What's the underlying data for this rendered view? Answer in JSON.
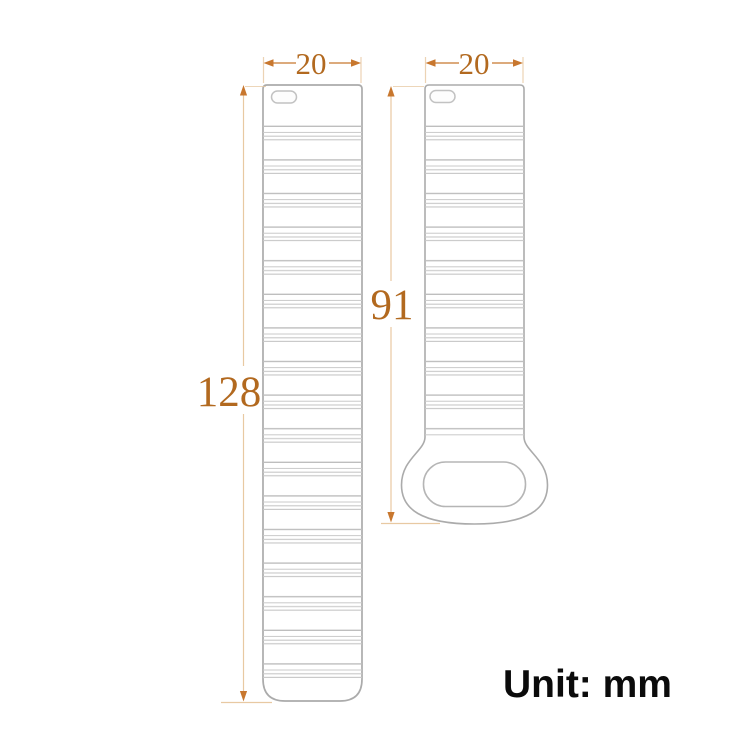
{
  "diagram": {
    "unit_label": "Unit: mm",
    "bands": {
      "long": {
        "name": "long watch band strap",
        "width_label": "20",
        "length_label": "128"
      },
      "short": {
        "name": "short watch band strap with loop",
        "width_label": "20",
        "length_label": "91"
      }
    },
    "colors": {
      "background": "#ffffff",
      "strap_outline": "#ababab",
      "rib_line": "#c6c6c6",
      "dimension_text": "#b2691f",
      "dimension_arrow": "#c8772e",
      "dimension_line_pale": "#e8c9a2",
      "unit_text": "#0b0b0b"
    }
  }
}
